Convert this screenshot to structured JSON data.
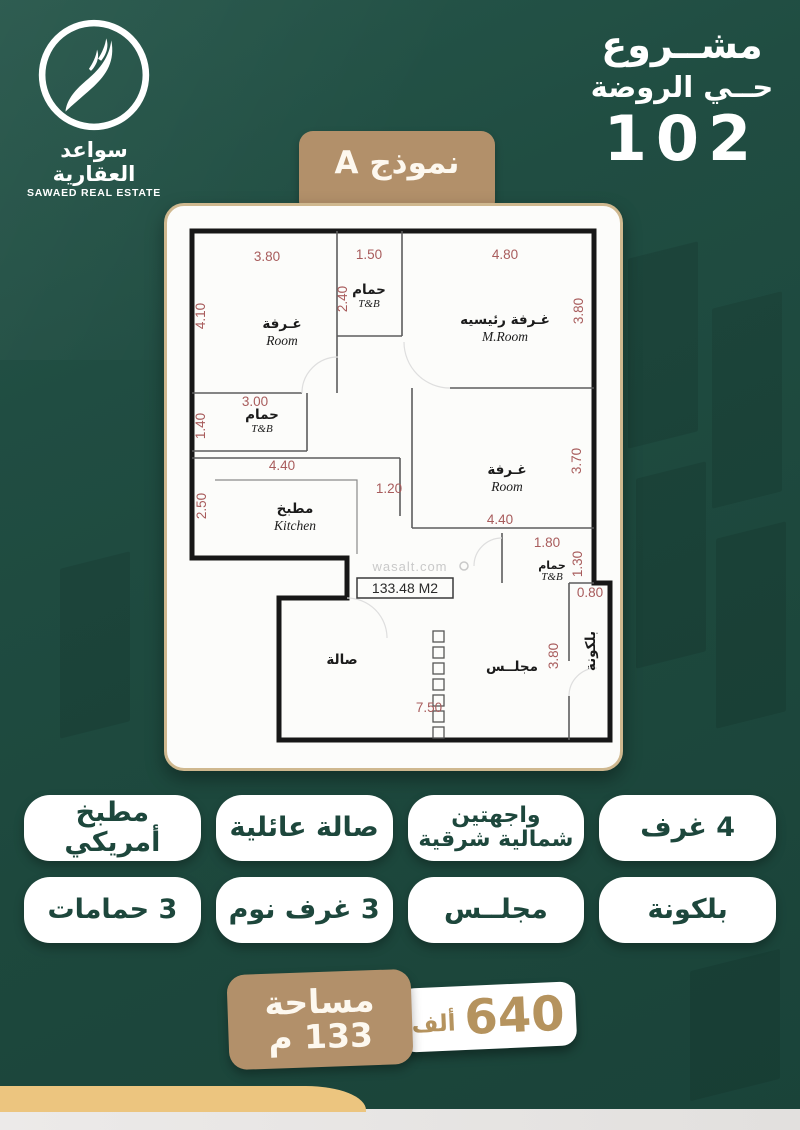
{
  "colors": {
    "background_green": "#1d483d",
    "accent_tan": "#b2906a",
    "gold_bar": "#ecc57f",
    "pill_text_green": "#1d473c",
    "dimension_red": "#a85c5c"
  },
  "brand": {
    "name_ar": "سواعد العقارية",
    "name_en": "SAWAED REAL ESTATE",
    "logo_icon": "falcon-swoosh"
  },
  "header": {
    "project_word": "مشــروع",
    "district": "حــي الروضة",
    "number": "102"
  },
  "model_ribbon": {
    "label": "نموذج A"
  },
  "plan": {
    "watermark": "wasalt.com",
    "area_box": "133.48 M2",
    "rooms": {
      "room1": {
        "ar": "غـرفة",
        "en": "Room",
        "w": "3.80",
        "h": "4.10"
      },
      "tb1": {
        "ar": "حمام",
        "en": "T&B",
        "w": "1.50",
        "h": "2.40"
      },
      "mroom": {
        "ar": "غـرفة رئيسيه",
        "en": "M.Room",
        "w": "4.80",
        "h": "3.80"
      },
      "tb2": {
        "ar": "حمام",
        "en": "T&B",
        "w": "3.00",
        "h": "1.40"
      },
      "kitchen": {
        "ar": "مطبخ",
        "en": "Kitchen",
        "w": "4.40",
        "h": "2.50"
      },
      "passage": {
        "w": "1.20"
      },
      "room2": {
        "ar": "غـرفة",
        "en": "Room",
        "w": "4.40",
        "h": "3.70"
      },
      "tb3": {
        "ar": "حمام",
        "en": "T&B",
        "w": "1.80",
        "h": "1.30"
      },
      "balcony": {
        "ar": "بلكونة",
        "w": "0.80",
        "h": "3.80"
      },
      "hall": {
        "ar": "صالة",
        "w": "7.50"
      },
      "majlis": {
        "ar": "مجلــس"
      }
    }
  },
  "features": [
    {
      "label": "مطبخ أمريكي"
    },
    {
      "label": "صالة عائلية"
    },
    {
      "line1": "واجهتين",
      "line2": "شمالية شرقية"
    },
    {
      "label": "4 غرف"
    },
    {
      "label": "3 حمامات"
    },
    {
      "label": "3 غرف نوم"
    },
    {
      "label": "مجلــس"
    },
    {
      "label": "بلكونة"
    }
  ],
  "footer": {
    "area_label": "مساحة",
    "area_value": "133 م",
    "price_number": "640",
    "price_unit": "ألف"
  }
}
